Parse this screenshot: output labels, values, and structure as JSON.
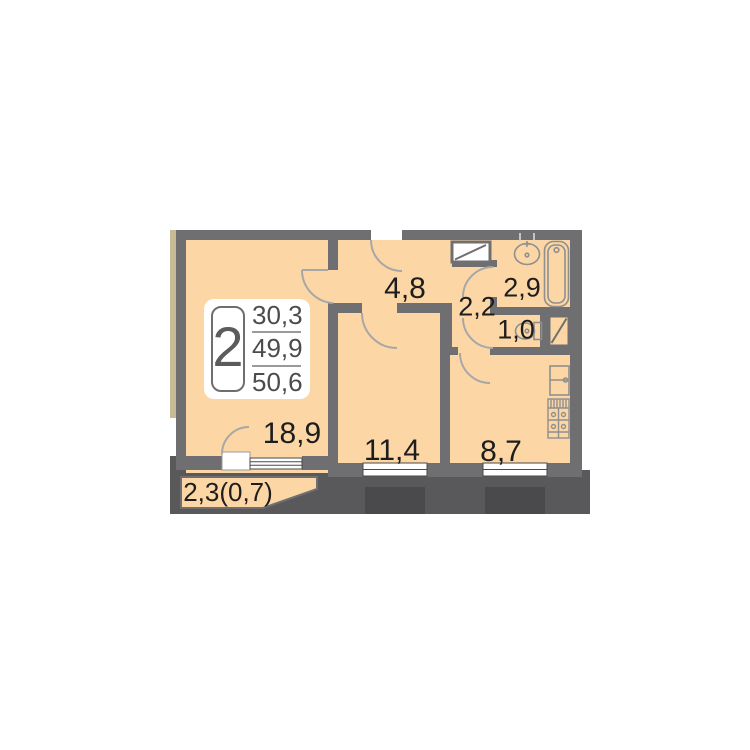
{
  "unit_badge": {
    "rooms_count": "2",
    "area_living": "30,3",
    "area_usable": "49,9",
    "area_total": "50,6"
  },
  "rooms": {
    "living_room": {
      "area": "18,9"
    },
    "bedroom": {
      "area": "11,4"
    },
    "kitchen": {
      "area": "8,7"
    },
    "hallway": {
      "area": "4,8"
    },
    "corridor": {
      "area": "2,2"
    },
    "bathroom": {
      "area": "2,9"
    },
    "toilet": {
      "area": "1,0"
    },
    "balcony": {
      "area": "2,3(0,7)"
    }
  },
  "colors": {
    "room_fill": "#fcd7a5",
    "wall": "#6f6f71",
    "ground": "#59595b",
    "window_bay": "#4a4a4c",
    "facade_strip": "#c8bc96",
    "label_text": "#1d1d1d"
  }
}
